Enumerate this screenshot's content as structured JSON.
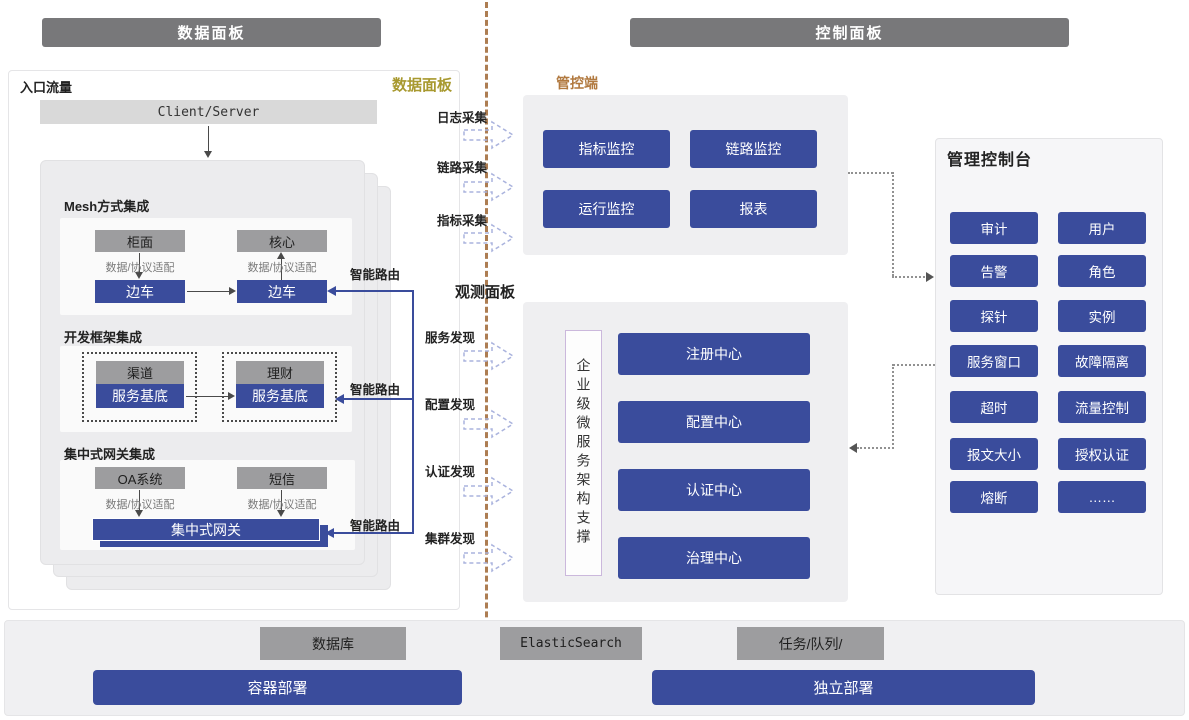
{
  "headers": {
    "data_plane": "数据面板",
    "control_plane": "控制面板"
  },
  "data_panel": {
    "entry_label": "入口流量",
    "corner_label": "数据面板",
    "client_server": "Client/Server",
    "mesh": {
      "title": "Mesh方式集成",
      "left_service": "柜面",
      "right_service": "核心",
      "adapter": "数据/协议适配",
      "sidecar": "边车"
    },
    "framework": {
      "title": "开发框架集成",
      "left_service": "渠道",
      "right_service": "理财",
      "base": "服务基底"
    },
    "gateway": {
      "title": "集中式网关集成",
      "left_service": "OA系统",
      "right_service": "短信",
      "adapter": "数据/协议适配",
      "gateway_bar": "集中式网关"
    },
    "smart_route": "智能路由"
  },
  "middle": {
    "collect": [
      "日志采集",
      "链路采集",
      "指标采集"
    ],
    "observe_panel_label": "观测面板",
    "discover": [
      "服务发现",
      "配置发现",
      "认证发现",
      "集群发现"
    ]
  },
  "control": {
    "label": "管控端",
    "monitors": [
      "指标监控",
      "链路监控",
      "运行监控",
      "报表"
    ]
  },
  "observe": {
    "vertical_support": "企业级微服务架构支撑",
    "centers": [
      "注册中心",
      "配置中心",
      "认证中心",
      "治理中心"
    ]
  },
  "console": {
    "title": "管理控制台",
    "items": [
      "审计",
      "用户",
      "告警",
      "角色",
      "探针",
      "实例",
      "服务窗口",
      "故障隔离",
      "超时",
      "流量控制",
      "报文大小",
      "授权认证",
      "熔断",
      "……"
    ]
  },
  "infra": {
    "database": "数据库",
    "container_deploy": "容器部署",
    "elasticsearch": "ElasticSearch",
    "task_queue": "任务/队列/",
    "standalone_deploy": "独立部署"
  },
  "colors": {
    "accent_blue": "#3a4c9c",
    "header_gray": "#78787a",
    "box_gray": "#9d9d9f",
    "divider_brown": "#ad7d52",
    "label_olive": "#a8992f",
    "label_orange": "#b1793f",
    "dashed_arrow": "#aab3dd"
  }
}
